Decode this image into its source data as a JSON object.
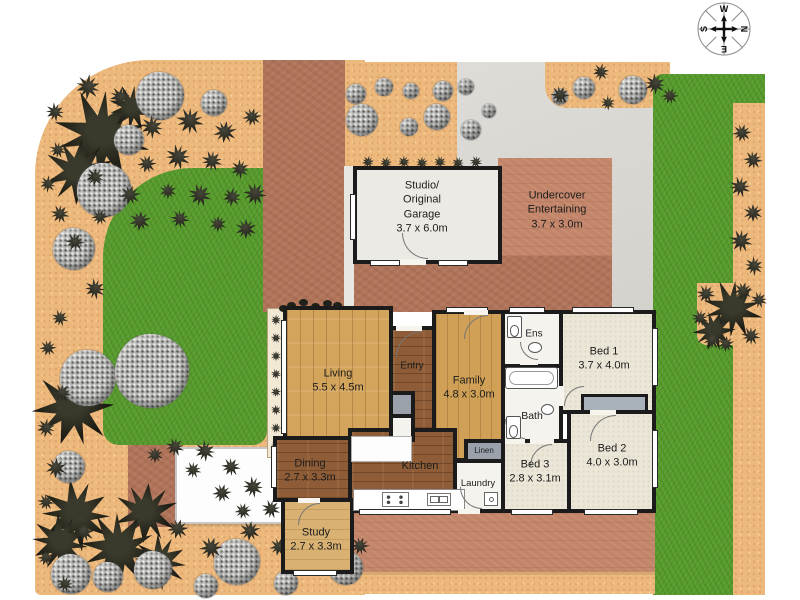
{
  "plan": {
    "w": 800,
    "h": 600,
    "colors": {
      "sand": "#edb87c",
      "lawn": "#579a2d",
      "driveway": "#b0745a",
      "paving": "#c28569",
      "concrete": "#dcdad5",
      "wall": "#1b1b1b",
      "wood_light": "#d2a45c",
      "wood_dark": "#8e5d37",
      "carpet": "#ebe6d7"
    },
    "regions": [
      {
        "cls": "sand",
        "name": "garden-bed-left",
        "x": 35,
        "y": 60,
        "w": 330,
        "h": 535,
        "radius": "115px 0 0 6px"
      },
      {
        "cls": "lawn",
        "name": "lawn-left",
        "x": 103,
        "y": 168,
        "w": 164,
        "h": 277,
        "radius": "90px 0 14px 16px"
      },
      {
        "cls": "terra",
        "name": "garden-path-red",
        "x": 128,
        "y": 445,
        "w": 48,
        "h": 82
      },
      {
        "cls": "terra",
        "name": "driveway",
        "x": 263,
        "y": 60,
        "w": 82,
        "h": 252
      },
      {
        "cls": "sand",
        "name": "garden-bed-top",
        "x": 345,
        "y": 62,
        "w": 155,
        "h": 106,
        "radius": "0 0 28px 14px"
      },
      {
        "cls": "concrete",
        "name": "concrete-area",
        "x": 457,
        "y": 62,
        "w": 198,
        "h": 248
      },
      {
        "cls": "sand",
        "name": "garden-bed-topright",
        "x": 545,
        "y": 62,
        "w": 125,
        "h": 46,
        "radius": "0 0 22px 22px"
      },
      {
        "cls": "lawn",
        "name": "lawn-right",
        "x": 653,
        "y": 74,
        "w": 112,
        "h": 521,
        "radius": "10px 0 0 0"
      },
      {
        "cls": "sand",
        "name": "path-right-edge",
        "x": 733,
        "y": 103,
        "w": 32,
        "h": 492
      },
      {
        "cls": "sand",
        "name": "garden-patch-right",
        "x": 697,
        "y": 283,
        "w": 68,
        "h": 62,
        "radius": "0 0 0 10px"
      },
      {
        "cls": "terra-light",
        "name": "undercover-paving",
        "x": 498,
        "y": 158,
        "w": 114,
        "h": 152
      },
      {
        "cls": "terra",
        "name": "courtyard-paving",
        "x": 263,
        "y": 256,
        "w": 349,
        "h": 56
      },
      {
        "cls": "concrete-strip",
        "name": "path-strip",
        "x": 344,
        "y": 166,
        "w": 10,
        "h": 146
      },
      {
        "cls": "terra-light",
        "name": "patio-paving",
        "x": 345,
        "y": 505,
        "w": 310,
        "h": 72
      },
      {
        "cls": "sand path-top-edge",
        "name": "path-bottom",
        "x": 345,
        "y": 572,
        "w": 310,
        "h": 22
      },
      {
        "cls": "shed",
        "name": "garden-shed",
        "x": 175,
        "y": 447,
        "w": 108,
        "h": 77
      },
      {
        "cls": "planter",
        "name": "planter-strip",
        "x": 267,
        "y": 308,
        "w": 18,
        "h": 150
      }
    ],
    "garden": {
      "palms": [
        [
          102,
          136,
          45
        ],
        [
          132,
          108,
          22
        ],
        [
          79,
          172,
          33
        ],
        [
          73,
          408,
          38
        ],
        [
          146,
          513,
          30
        ],
        [
          76,
          515,
          34
        ],
        [
          60,
          543,
          28
        ],
        [
          119,
          549,
          36
        ],
        [
          160,
          562,
          26
        ],
        [
          733,
          309,
          28
        ],
        [
          714,
          331,
          20
        ]
      ],
      "bushes": [
        [
          160,
          96,
          24
        ],
        [
          214,
          103,
          13
        ],
        [
          129,
          140,
          15
        ],
        [
          104,
          190,
          27
        ],
        [
          74,
          249,
          21
        ],
        [
          88,
          378,
          28
        ],
        [
          152,
          371,
          37
        ],
        [
          69,
          467,
          16
        ],
        [
          71,
          574,
          20
        ],
        [
          108,
          577,
          15
        ],
        [
          153,
          570,
          19
        ],
        [
          206,
          586,
          12
        ],
        [
          237,
          562,
          23
        ],
        [
          286,
          583,
          12
        ],
        [
          346,
          568,
          17
        ],
        [
          362,
          120,
          16
        ],
        [
          356,
          94,
          10
        ],
        [
          384,
          87,
          9
        ],
        [
          411,
          91,
          8
        ],
        [
          437,
          117,
          13
        ],
        [
          443,
          91,
          10
        ],
        [
          466,
          87,
          8
        ],
        [
          471,
          130,
          10
        ],
        [
          489,
          111,
          7
        ],
        [
          409,
          127,
          9
        ],
        [
          633,
          90,
          14
        ],
        [
          584,
          88,
          11
        ],
        [
          560,
          97,
          8
        ]
      ],
      "shrubs": [
        [
          88,
          87,
          12
        ],
        [
          120,
          97,
          10
        ],
        [
          55,
          112,
          9
        ],
        [
          152,
          127,
          11
        ],
        [
          190,
          121,
          13
        ],
        [
          225,
          132,
          11
        ],
        [
          252,
          117,
          9
        ],
        [
          58,
          150,
          8
        ],
        [
          147,
          164,
          9
        ],
        [
          178,
          157,
          12
        ],
        [
          212,
          161,
          10
        ],
        [
          240,
          169,
          9
        ],
        [
          48,
          184,
          8
        ],
        [
          95,
          177,
          9
        ],
        [
          130,
          195,
          10
        ],
        [
          168,
          191,
          8
        ],
        [
          200,
          195,
          11
        ],
        [
          232,
          197,
          9
        ],
        [
          255,
          194,
          11
        ],
        [
          60,
          214,
          9
        ],
        [
          100,
          217,
          8
        ],
        [
          140,
          221,
          10
        ],
        [
          180,
          219,
          9
        ],
        [
          218,
          224,
          8
        ],
        [
          246,
          229,
          10
        ],
        [
          75,
          242,
          9
        ],
        [
          95,
          289,
          10
        ],
        [
          60,
          318,
          8
        ],
        [
          48,
          348,
          8
        ],
        [
          62,
          393,
          9
        ],
        [
          46,
          428,
          9
        ],
        [
          56,
          468,
          10
        ],
        [
          46,
          502,
          8
        ],
        [
          84,
          532,
          10
        ],
        [
          46,
          558,
          8
        ],
        [
          65,
          584,
          8
        ],
        [
          175,
          447,
          9
        ],
        [
          205,
          451,
          10
        ],
        [
          231,
          467,
          9
        ],
        [
          253,
          487,
          10
        ],
        [
          271,
          509,
          9
        ],
        [
          155,
          455,
          8
        ],
        [
          193,
          470,
          8
        ],
        [
          222,
          493,
          9
        ],
        [
          243,
          511,
          8
        ],
        [
          178,
          529,
          10
        ],
        [
          211,
          548,
          11
        ],
        [
          250,
          531,
          10
        ],
        [
          279,
          547,
          9
        ],
        [
          311,
          541,
          10
        ],
        [
          338,
          531,
          8
        ],
        [
          360,
          546,
          9
        ],
        [
          310,
          558,
          8
        ],
        [
          368,
          162,
          6
        ],
        [
          386,
          163,
          6
        ],
        [
          404,
          162,
          6
        ],
        [
          422,
          163,
          6
        ],
        [
          440,
          162,
          6
        ],
        [
          458,
          163,
          6
        ],
        [
          476,
          162,
          6
        ],
        [
          560,
          95,
          9
        ],
        [
          601,
          72,
          8
        ],
        [
          655,
          84,
          10
        ],
        [
          670,
          96,
          8
        ],
        [
          608,
          103,
          7
        ],
        [
          742,
          133,
          9
        ],
        [
          753,
          160,
          9
        ],
        [
          740,
          187,
          10
        ],
        [
          753,
          213,
          9
        ],
        [
          741,
          241,
          11
        ],
        [
          754,
          266,
          9
        ],
        [
          743,
          291,
          9
        ],
        [
          706,
          294,
          9
        ],
        [
          700,
          318,
          8
        ],
        [
          712,
          340,
          9
        ],
        [
          751,
          336,
          9
        ],
        [
          759,
          300,
          8
        ],
        [
          726,
          344,
          8
        ],
        [
          276,
          320,
          5
        ],
        [
          276,
          338,
          5
        ],
        [
          276,
          356,
          5
        ],
        [
          276,
          374,
          5
        ],
        [
          276,
          392,
          5
        ],
        [
          276,
          410,
          5
        ],
        [
          276,
          428,
          5
        ],
        [
          276,
          446,
          5
        ]
      ],
      "dots": [
        [
          291,
          305
        ],
        [
          303,
          302
        ],
        [
          315,
          306
        ],
        [
          327,
          303
        ],
        [
          337,
          305
        ],
        [
          283,
          308
        ]
      ]
    },
    "rooms": [
      {
        "id": "studio",
        "floor": "concrete-room",
        "x": 353,
        "y": 166,
        "w": 149,
        "h": 98,
        "lines": [
          "Studio/",
          "Original",
          "Garage",
          "3.7 x 6.0m"
        ],
        "lx": 422,
        "ly": 207
      },
      {
        "id": "undercover",
        "ghost": true,
        "floor": "tile",
        "x": 498,
        "y": 158,
        "w": 114,
        "h": 152,
        "lines": [
          "Undercover",
          "Entertaining",
          "3.7 x 3.0m"
        ],
        "lx": 557,
        "ly": 210
      },
      {
        "id": "living",
        "floor": "wood-light",
        "x": 283,
        "y": 306,
        "w": 110,
        "h": 138,
        "lines": [
          "Living",
          "5.5 x 4.5m"
        ],
        "lx": 338,
        "ly": 381
      },
      {
        "id": "entry",
        "floor": "wood-dark",
        "x": 389,
        "y": 326,
        "w": 47,
        "h": 106,
        "lines": [
          "Entry"
        ],
        "lx": 412,
        "ly": 366,
        "fs": 10
      },
      {
        "id": "family",
        "floor": "wood-mid",
        "x": 432,
        "y": 310,
        "w": 73,
        "h": 152,
        "lines": [
          "Family",
          "4.8 x 3.0m"
        ],
        "lx": 469,
        "ly": 388
      },
      {
        "id": "ens",
        "floor": "tile",
        "x": 501,
        "y": 310,
        "w": 62,
        "h": 58,
        "lines": [
          "Ens"
        ],
        "lx": 534,
        "ly": 334,
        "fs": 10
      },
      {
        "id": "bath",
        "floor": "tile",
        "x": 501,
        "y": 364,
        "w": 62,
        "h": 79,
        "lines": [
          "Bath"
        ],
        "lx": 532,
        "ly": 417,
        "fs": 10.5
      },
      {
        "id": "bed1",
        "floor": "carpet",
        "x": 559,
        "y": 310,
        "w": 97,
        "h": 104,
        "lines": [
          "Bed 1",
          "3.7 x 4.0m"
        ],
        "lx": 604,
        "ly": 359
      },
      {
        "id": "bed2",
        "floor": "carpet",
        "x": 567,
        "y": 410,
        "w": 89,
        "h": 103,
        "lines": [
          "Bed 2",
          "4.0 x 3.0m"
        ],
        "lx": 612,
        "ly": 456
      },
      {
        "id": "bed3",
        "floor": "carpet",
        "x": 501,
        "y": 439,
        "w": 70,
        "h": 74,
        "lines": [
          "Bed 3",
          "2.8 x 3.1m"
        ],
        "lx": 535,
        "ly": 472
      },
      {
        "id": "laundry",
        "floor": "tile",
        "x": 453,
        "y": 459,
        "w": 52,
        "h": 54,
        "lines": [
          "Laundry"
        ],
        "lx": 478,
        "ly": 484,
        "fs": 9.5
      },
      {
        "id": "linen",
        "floor": "gray",
        "x": 464,
        "y": 439,
        "w": 41,
        "h": 24,
        "lines": [
          "Linen"
        ],
        "lx": 484,
        "ly": 451,
        "fs": 8
      },
      {
        "id": "kitchen",
        "floor": "wood-dark",
        "x": 348,
        "y": 428,
        "w": 109,
        "h": 85,
        "lines": [
          "Kitchen"
        ],
        "lx": 420,
        "ly": 466
      },
      {
        "id": "dining",
        "floor": "wood-dark",
        "x": 273,
        "y": 436,
        "w": 79,
        "h": 66,
        "lines": [
          "Dining",
          "2.7 x 3.3m"
        ],
        "lx": 310,
        "ly": 471
      },
      {
        "id": "study",
        "floor": "wood-study",
        "x": 281,
        "y": 498,
        "w": 73,
        "h": 76,
        "lines": [
          "Study",
          "2.7 x 3.3m"
        ],
        "lx": 316,
        "ly": 540
      },
      {
        "id": "closet1",
        "floor": "gray",
        "x": 389,
        "y": 391,
        "w": 26,
        "h": 27,
        "lines": [],
        "lx": 0,
        "ly": 0
      },
      {
        "id": "closet2",
        "floor": "tile",
        "x": 389,
        "y": 414,
        "w": 26,
        "h": 28,
        "lines": [],
        "lx": 0,
        "ly": 0
      }
    ],
    "boxes": [
      {
        "cls": "island",
        "name": "kitchen-island",
        "x": 351,
        "y": 436,
        "w": 61,
        "h": 26
      },
      {
        "cls": "counter",
        "name": "kitchen-counter",
        "x": 353,
        "y": 489,
        "w": 112,
        "h": 22
      },
      {
        "cls": "robe",
        "name": "built-in-robe",
        "x": 581,
        "y": 394,
        "w": 67,
        "h": 19
      }
    ],
    "windows": [
      [
        281,
        320,
        6,
        114
      ],
      [
        271,
        446,
        6,
        42
      ],
      [
        446,
        307,
        42,
        6
      ],
      [
        509,
        307,
        36,
        6
      ],
      [
        572,
        307,
        62,
        6
      ],
      [
        652,
        328,
        6,
        58
      ],
      [
        652,
        430,
        6,
        58
      ],
      [
        584,
        509,
        54,
        6
      ],
      [
        511,
        509,
        42,
        6
      ],
      [
        293,
        570,
        44,
        6
      ],
      [
        350,
        194,
        6,
        46
      ],
      [
        370,
        260,
        30,
        6
      ],
      [
        438,
        260,
        30,
        6
      ],
      [
        359,
        509,
        92,
        6
      ]
    ],
    "gaps": [
      [
        400,
        259,
        26,
        6
      ],
      [
        396,
        326,
        26,
        5
      ],
      [
        464,
        310,
        24,
        5
      ],
      [
        590,
        410,
        26,
        5
      ],
      [
        530,
        439,
        24,
        5
      ],
      [
        505,
        439,
        20,
        5
      ],
      [
        458,
        509,
        22,
        5
      ],
      [
        298,
        498,
        22,
        5
      ],
      [
        520,
        360,
        18,
        5
      ],
      [
        559,
        386,
        5,
        20
      ]
    ],
    "arcs": [
      [
        402,
        233,
        26,
        "bl"
      ],
      [
        396,
        331,
        26,
        "tl"
      ],
      [
        464,
        315,
        24,
        "tl"
      ],
      [
        590,
        415,
        26,
        "tl"
      ],
      [
        530,
        444,
        22,
        "tl"
      ],
      [
        505,
        419,
        20,
        "bl"
      ],
      [
        460,
        487,
        22,
        "bl"
      ],
      [
        298,
        503,
        22,
        "tl"
      ],
      [
        520,
        342,
        18,
        "bl"
      ],
      [
        564,
        386,
        20,
        "tl"
      ]
    ],
    "fixtures": [
      {
        "t": "tub",
        "x": 505,
        "y": 367,
        "w": 53,
        "h": 22
      },
      {
        "t": "toilet",
        "x": 507,
        "y": 316,
        "w": 15,
        "h": 22
      },
      {
        "t": "basin",
        "x": 528,
        "y": 342,
        "w": 14,
        "h": 11
      },
      {
        "t": "toilet",
        "x": 506,
        "y": 416,
        "w": 15,
        "h": 23
      },
      {
        "t": "basin",
        "x": 541,
        "y": 404,
        "w": 13,
        "h": 11
      },
      {
        "t": "stove",
        "x": 382,
        "y": 492,
        "w": 27,
        "h": 15
      },
      {
        "t": "sink",
        "x": 427,
        "y": 493,
        "w": 24,
        "h": 13
      },
      {
        "t": "trough",
        "x": 484,
        "y": 492,
        "w": 14,
        "h": 14
      }
    ],
    "compass": {
      "cx": 724,
      "cy": 29,
      "r": 26,
      "points": [
        "W",
        "N",
        "E",
        "S"
      ]
    }
  }
}
